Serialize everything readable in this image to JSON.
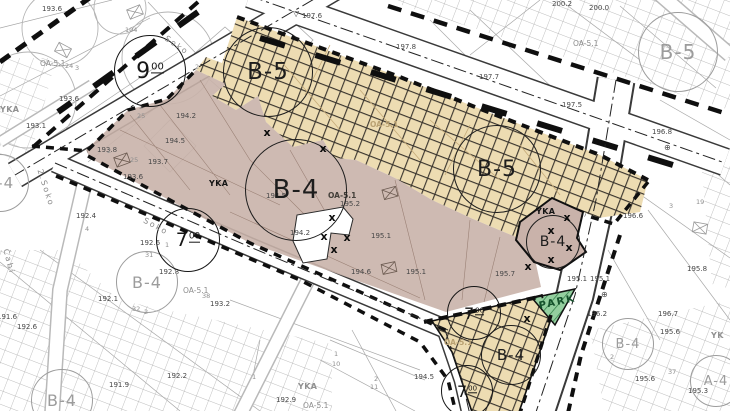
{
  "map": {
    "colors": {
      "zone_b4_fill": "#c9b2aa",
      "zone_b5_fill": "#eddcb2",
      "hatch_line": "#38332c",
      "park_fill": "#94cf9f",
      "park_hatch": "#2c7a43",
      "boundary": "#0f0f0f",
      "road_edge": "#3a3a3a",
      "cadastral_gray": "#a8a8a8"
    },
    "zone_codes_visible": [
      "B-4",
      "B-5",
      "PARK",
      "OA-5.1",
      "YKA"
    ],
    "x_glyph": "x",
    "park": {
      "label": "PARK",
      "x": 538,
      "y": 301,
      "rot": -12
    },
    "zone_circles": [
      {
        "label": "B-5",
        "x": 268,
        "y": 72,
        "r": 45,
        "style": "plan"
      },
      {
        "label": "B-5",
        "x": 497,
        "y": 169,
        "r": 44,
        "style": "plan"
      },
      {
        "label": "B-4",
        "x": 296,
        "y": 190,
        "r": 51,
        "style": "plan"
      },
      {
        "label": "B-4",
        "x": 553,
        "y": 242,
        "r": 27,
        "style": "plan"
      },
      {
        "label": "B-4",
        "x": 511,
        "y": 355,
        "r": 30,
        "style": "plan"
      },
      {
        "label": "B-5",
        "x": 678,
        "y": 52,
        "r": 40,
        "style": "bg"
      },
      {
        "label": "B-4",
        "x": 147,
        "y": 282,
        "r": 31,
        "style": "bg"
      },
      {
        "label": "B-4",
        "x": 628,
        "y": 344,
        "r": 26,
        "style": "bg"
      },
      {
        "label": "B-4",
        "x": 0,
        "y": 183,
        "r": 29,
        "style": "bg"
      },
      {
        "label": "B-4",
        "x": 62,
        "y": 400,
        "r": 31,
        "style": "bg"
      },
      {
        "label": "A-4",
        "x": 716,
        "y": 381,
        "r": 26,
        "style": "bg"
      }
    ],
    "width_circles": [
      {
        "main": "9",
        "sup": "00",
        "x": 150,
        "y": 71,
        "r": 36
      },
      {
        "main": "7",
        "sup": "00",
        "x": 188,
        "y": 240,
        "r": 32
      },
      {
        "main": "7",
        "sup": "00",
        "x": 474,
        "y": 313,
        "r": 27
      },
      {
        "main": "7",
        "sup": "00",
        "x": 467,
        "y": 391,
        "r": 26
      }
    ],
    "labels": [
      {
        "t": "197.6",
        "x": 302,
        "y": 13,
        "k": "elev"
      },
      {
        "t": "197.8",
        "x": 396,
        "y": 44,
        "k": "elev"
      },
      {
        "t": "197.7",
        "x": 479,
        "y": 74,
        "k": "elev"
      },
      {
        "t": "197.5",
        "x": 562,
        "y": 102,
        "k": "elev"
      },
      {
        "t": "196.8",
        "x": 652,
        "y": 129,
        "k": "elev"
      },
      {
        "t": "200.2",
        "x": 552,
        "y": 1,
        "k": "elev"
      },
      {
        "t": "200.0",
        "x": 589,
        "y": 5,
        "k": "elev"
      },
      {
        "t": "194.2",
        "x": 176,
        "y": 113,
        "k": "elev"
      },
      {
        "t": "194.5",
        "x": 165,
        "y": 138,
        "k": "elev"
      },
      {
        "t": "193.7",
        "x": 148,
        "y": 159,
        "k": "elev"
      },
      {
        "t": "193.6",
        "x": 123,
        "y": 174,
        "k": "elev"
      },
      {
        "t": "193.6",
        "x": 59,
        "y": 96,
        "k": "elev"
      },
      {
        "t": "193.1",
        "x": 26,
        "y": 123,
        "k": "elev"
      },
      {
        "t": "193.6",
        "x": 42,
        "y": 6,
        "k": "elev"
      },
      {
        "t": "193.8",
        "x": 97,
        "y": 147,
        "k": "elev"
      },
      {
        "t": "192.4",
        "x": 76,
        "y": 213,
        "k": "elev"
      },
      {
        "t": "192.6",
        "x": 140,
        "y": 240,
        "k": "elev"
      },
      {
        "t": "192.8",
        "x": 159,
        "y": 269,
        "k": "elev"
      },
      {
        "t": "192.1",
        "x": 98,
        "y": 296,
        "k": "elev"
      },
      {
        "t": "193.2",
        "x": 210,
        "y": 301,
        "k": "elev"
      },
      {
        "t": "191.6",
        "x": -3,
        "y": 314,
        "k": "elev"
      },
      {
        "t": "192.9",
        "x": 276,
        "y": 397,
        "k": "elev"
      },
      {
        "t": "191.9",
        "x": 109,
        "y": 382,
        "k": "elev"
      },
      {
        "t": "192.2",
        "x": 167,
        "y": 373,
        "k": "elev"
      },
      {
        "t": "192.6",
        "x": 17,
        "y": 324,
        "k": "elev"
      },
      {
        "t": "195.2",
        "x": 340,
        "y": 201,
        "k": "elev"
      },
      {
        "t": "195.1",
        "x": 371,
        "y": 233,
        "k": "elev"
      },
      {
        "t": "195.1",
        "x": 406,
        "y": 269,
        "k": "elev"
      },
      {
        "t": "194.6",
        "x": 351,
        "y": 269,
        "k": "elev"
      },
      {
        "t": "194.2",
        "x": 290,
        "y": 230,
        "k": "elev"
      },
      {
        "t": "194.5",
        "x": 266,
        "y": 193,
        "k": "elev"
      },
      {
        "t": "195.1",
        "x": 567,
        "y": 276,
        "k": "elev"
      },
      {
        "t": "195.1",
        "x": 590,
        "y": 276,
        "k": "elev"
      },
      {
        "t": "195.7",
        "x": 495,
        "y": 271,
        "k": "elev"
      },
      {
        "t": "195.8",
        "x": 687,
        "y": 266,
        "k": "elev"
      },
      {
        "t": "196.2",
        "x": 587,
        "y": 311,
        "k": "elev"
      },
      {
        "t": "196.7",
        "x": 658,
        "y": 311,
        "k": "elev"
      },
      {
        "t": "195.6",
        "x": 660,
        "y": 329,
        "k": "elev"
      },
      {
        "t": "195.6",
        "x": 635,
        "y": 376,
        "k": "elev"
      },
      {
        "t": "195.3",
        "x": 688,
        "y": 388,
        "k": "elev"
      },
      {
        "t": "194.5",
        "x": 414,
        "y": 374,
        "k": "elev"
      },
      {
        "t": "196.6",
        "x": 623,
        "y": 213,
        "k": "elev"
      },
      {
        "t": "104",
        "x": 125,
        "y": 27,
        "k": "parcel"
      },
      {
        "t": "2",
        "x": 139,
        "y": 104,
        "k": "parcel"
      },
      {
        "t": "25",
        "x": 137,
        "y": 113,
        "k": "parcel"
      },
      {
        "t": "2",
        "x": 195,
        "y": 64,
        "k": "parcel"
      },
      {
        "t": "25",
        "x": 130,
        "y": 157,
        "k": "parcel"
      },
      {
        "t": "4",
        "x": 85,
        "y": 226,
        "k": "parcel"
      },
      {
        "t": "31",
        "x": 145,
        "y": 252,
        "k": "parcel"
      },
      {
        "t": "1",
        "x": 165,
        "y": 242,
        "k": "parcel"
      },
      {
        "t": "38",
        "x": 202,
        "y": 293,
        "k": "parcel"
      },
      {
        "t": "32",
        "x": 132,
        "y": 306,
        "k": "parcel"
      },
      {
        "t": "2",
        "x": 144,
        "y": 309,
        "k": "parcel"
      },
      {
        "t": "1",
        "x": 252,
        "y": 374,
        "k": "parcel"
      },
      {
        "t": "1",
        "x": 334,
        "y": 351,
        "k": "parcel"
      },
      {
        "t": "10",
        "x": 332,
        "y": 361,
        "k": "parcel"
      },
      {
        "t": "2",
        "x": 374,
        "y": 376,
        "k": "parcel"
      },
      {
        "t": "11",
        "x": 370,
        "y": 384,
        "k": "parcel"
      },
      {
        "t": "3",
        "x": 669,
        "y": 203,
        "k": "parcel"
      },
      {
        "t": "19",
        "x": 696,
        "y": 199,
        "k": "parcel"
      },
      {
        "t": "2",
        "x": 610,
        "y": 354,
        "k": "parcel"
      },
      {
        "t": "37",
        "x": 668,
        "y": 369,
        "k": "parcel"
      },
      {
        "t": "24",
        "x": 65,
        "y": 63,
        "k": "parcel"
      },
      {
        "t": "3",
        "x": 75,
        "y": 65,
        "k": "parcel"
      },
      {
        "t": "2",
        "x": 107,
        "y": 148,
        "k": "parcel"
      },
      {
        "t": "OA-5.1",
        "x": 328,
        "y": 192,
        "k": "code"
      },
      {
        "t": "OA-5.1",
        "x": 183,
        "y": 287,
        "k": "code-gray"
      },
      {
        "t": "OA-5.1",
        "x": 40,
        "y": 60,
        "k": "code-gray"
      },
      {
        "t": "OA-5.1",
        "x": 303,
        "y": 402,
        "k": "code-gray"
      },
      {
        "t": "OA-5.1",
        "x": 573,
        "y": 40,
        "k": "code-gray"
      },
      {
        "t": "OA-5.1",
        "x": 370,
        "y": 121,
        "k": "code-faint"
      },
      {
        "t": "OA-5.1",
        "x": 444,
        "y": 339,
        "k": "code-faint"
      },
      {
        "t": "YKA",
        "x": 209,
        "y": 180,
        "k": "yka"
      },
      {
        "t": "YKA",
        "x": 536,
        "y": 208,
        "k": "yka"
      },
      {
        "t": "YKA",
        "x": 0,
        "y": 106,
        "k": "yka-gray"
      },
      {
        "t": "YKA",
        "x": 298,
        "y": 383,
        "k": "yka-gray"
      },
      {
        "t": "YK",
        "x": 711,
        "y": 332,
        "k": "yka-gray"
      }
    ],
    "street_names": [
      {
        "t": "Soko",
        "x": 146,
        "y": 216,
        "rot": 28
      },
      {
        "t": "2.Soko",
        "x": 44,
        "y": 168,
        "rot": 72
      },
      {
        "t": "Čabi",
        "x": 10,
        "y": 248,
        "rot": 75
      },
      {
        "t": "Soko",
        "x": 168,
        "y": 34,
        "rot": 34
      }
    ],
    "x_marks": [
      [
        267,
        133
      ],
      [
        323,
        149
      ],
      [
        332,
        218
      ],
      [
        324,
        237
      ],
      [
        347,
        238
      ],
      [
        334,
        250
      ],
      [
        551,
        231
      ],
      [
        551,
        260
      ],
      [
        569,
        248
      ],
      [
        528,
        267
      ],
      [
        567,
        218
      ],
      [
        527,
        319
      ]
    ],
    "symbols": [
      {
        "g": "▽",
        "x": 293,
        "y": 10
      },
      {
        "g": "⊕",
        "x": 601,
        "y": 291
      },
      {
        "g": "⊕",
        "x": 664,
        "y": 144
      }
    ]
  }
}
